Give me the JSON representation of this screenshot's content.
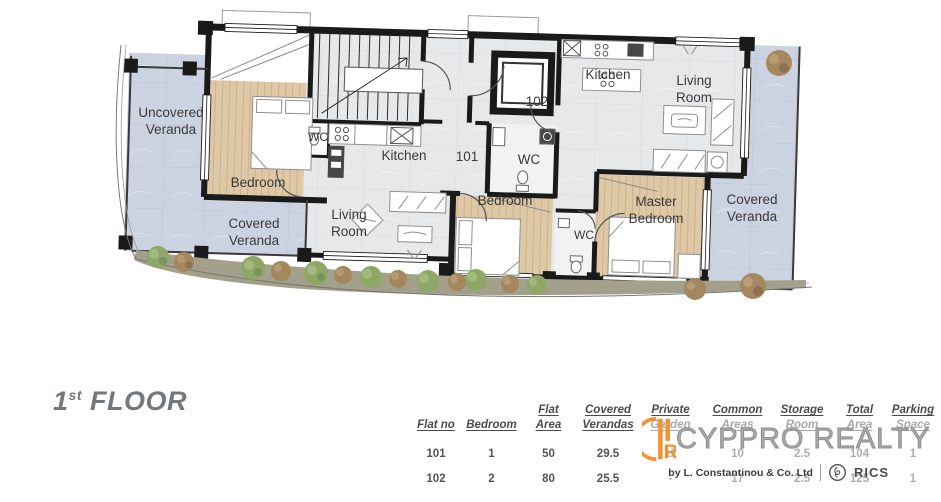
{
  "floor_title": {
    "number": "1",
    "ordinal": "st",
    "word": "FLOOR"
  },
  "plan": {
    "rooms": {
      "uncovered_veranda": {
        "line1": "Uncovered",
        "line2": "Veranda"
      },
      "covered_veranda_left": {
        "line1": "Covered",
        "line2": "Veranda"
      },
      "covered_veranda_right": {
        "line1": "Covered",
        "line2": "Veranda"
      },
      "bedroom_101": "Bedroom",
      "wc_101": "WC",
      "kitchen_101": "Kitchen",
      "living_room_101": {
        "line1": "Living",
        "line2": "Room"
      },
      "unit_101": "101",
      "unit_102": "102",
      "wc_102": "WC",
      "wc_102_small": "WC",
      "bedroom_102": "Bedroom",
      "master_bedroom": {
        "line1": "Master",
        "line2": "Bedroom"
      },
      "kitchen_102": "Kitchen",
      "living_room_102": {
        "line1": "Living",
        "line2": "Room"
      }
    },
    "colors": {
      "wall": "#1a1a1a",
      "veranda_tile": "#ccd3e0",
      "interior_floor": "#e7e8ea",
      "wood_floor": "#dec8a6",
      "garden": "#a4a18a",
      "bush_green": "#8ea766",
      "bush_brown": "#a3875f",
      "label_text": "#3a3a3a"
    }
  },
  "table": {
    "headers": [
      [
        "Flat no",
        ""
      ],
      [
        "Bedroom",
        ""
      ],
      [
        "Flat",
        "Area"
      ],
      [
        "Covered",
        "Verandas"
      ],
      [
        "Private",
        "Garden"
      ],
      [
        "Common",
        "Areas"
      ],
      [
        "Storage",
        "Room"
      ],
      [
        "Total",
        "Area"
      ],
      [
        "Parking",
        "Space"
      ]
    ],
    "rows": [
      [
        "101",
        "1",
        "50",
        "29.5",
        "12",
        "10",
        "2.5",
        "104",
        "1"
      ],
      [
        "102",
        "2",
        "80",
        "25.5",
        "-",
        "17",
        "2.5",
        "125",
        "1"
      ]
    ]
  },
  "watermark": {
    "brand": "CYPPRO REALTY",
    "logo_letter": "R",
    "byline": "by L. Constantinou & Co. Ltd",
    "rics_label": "RICS",
    "accent_color": "#ef9434"
  }
}
